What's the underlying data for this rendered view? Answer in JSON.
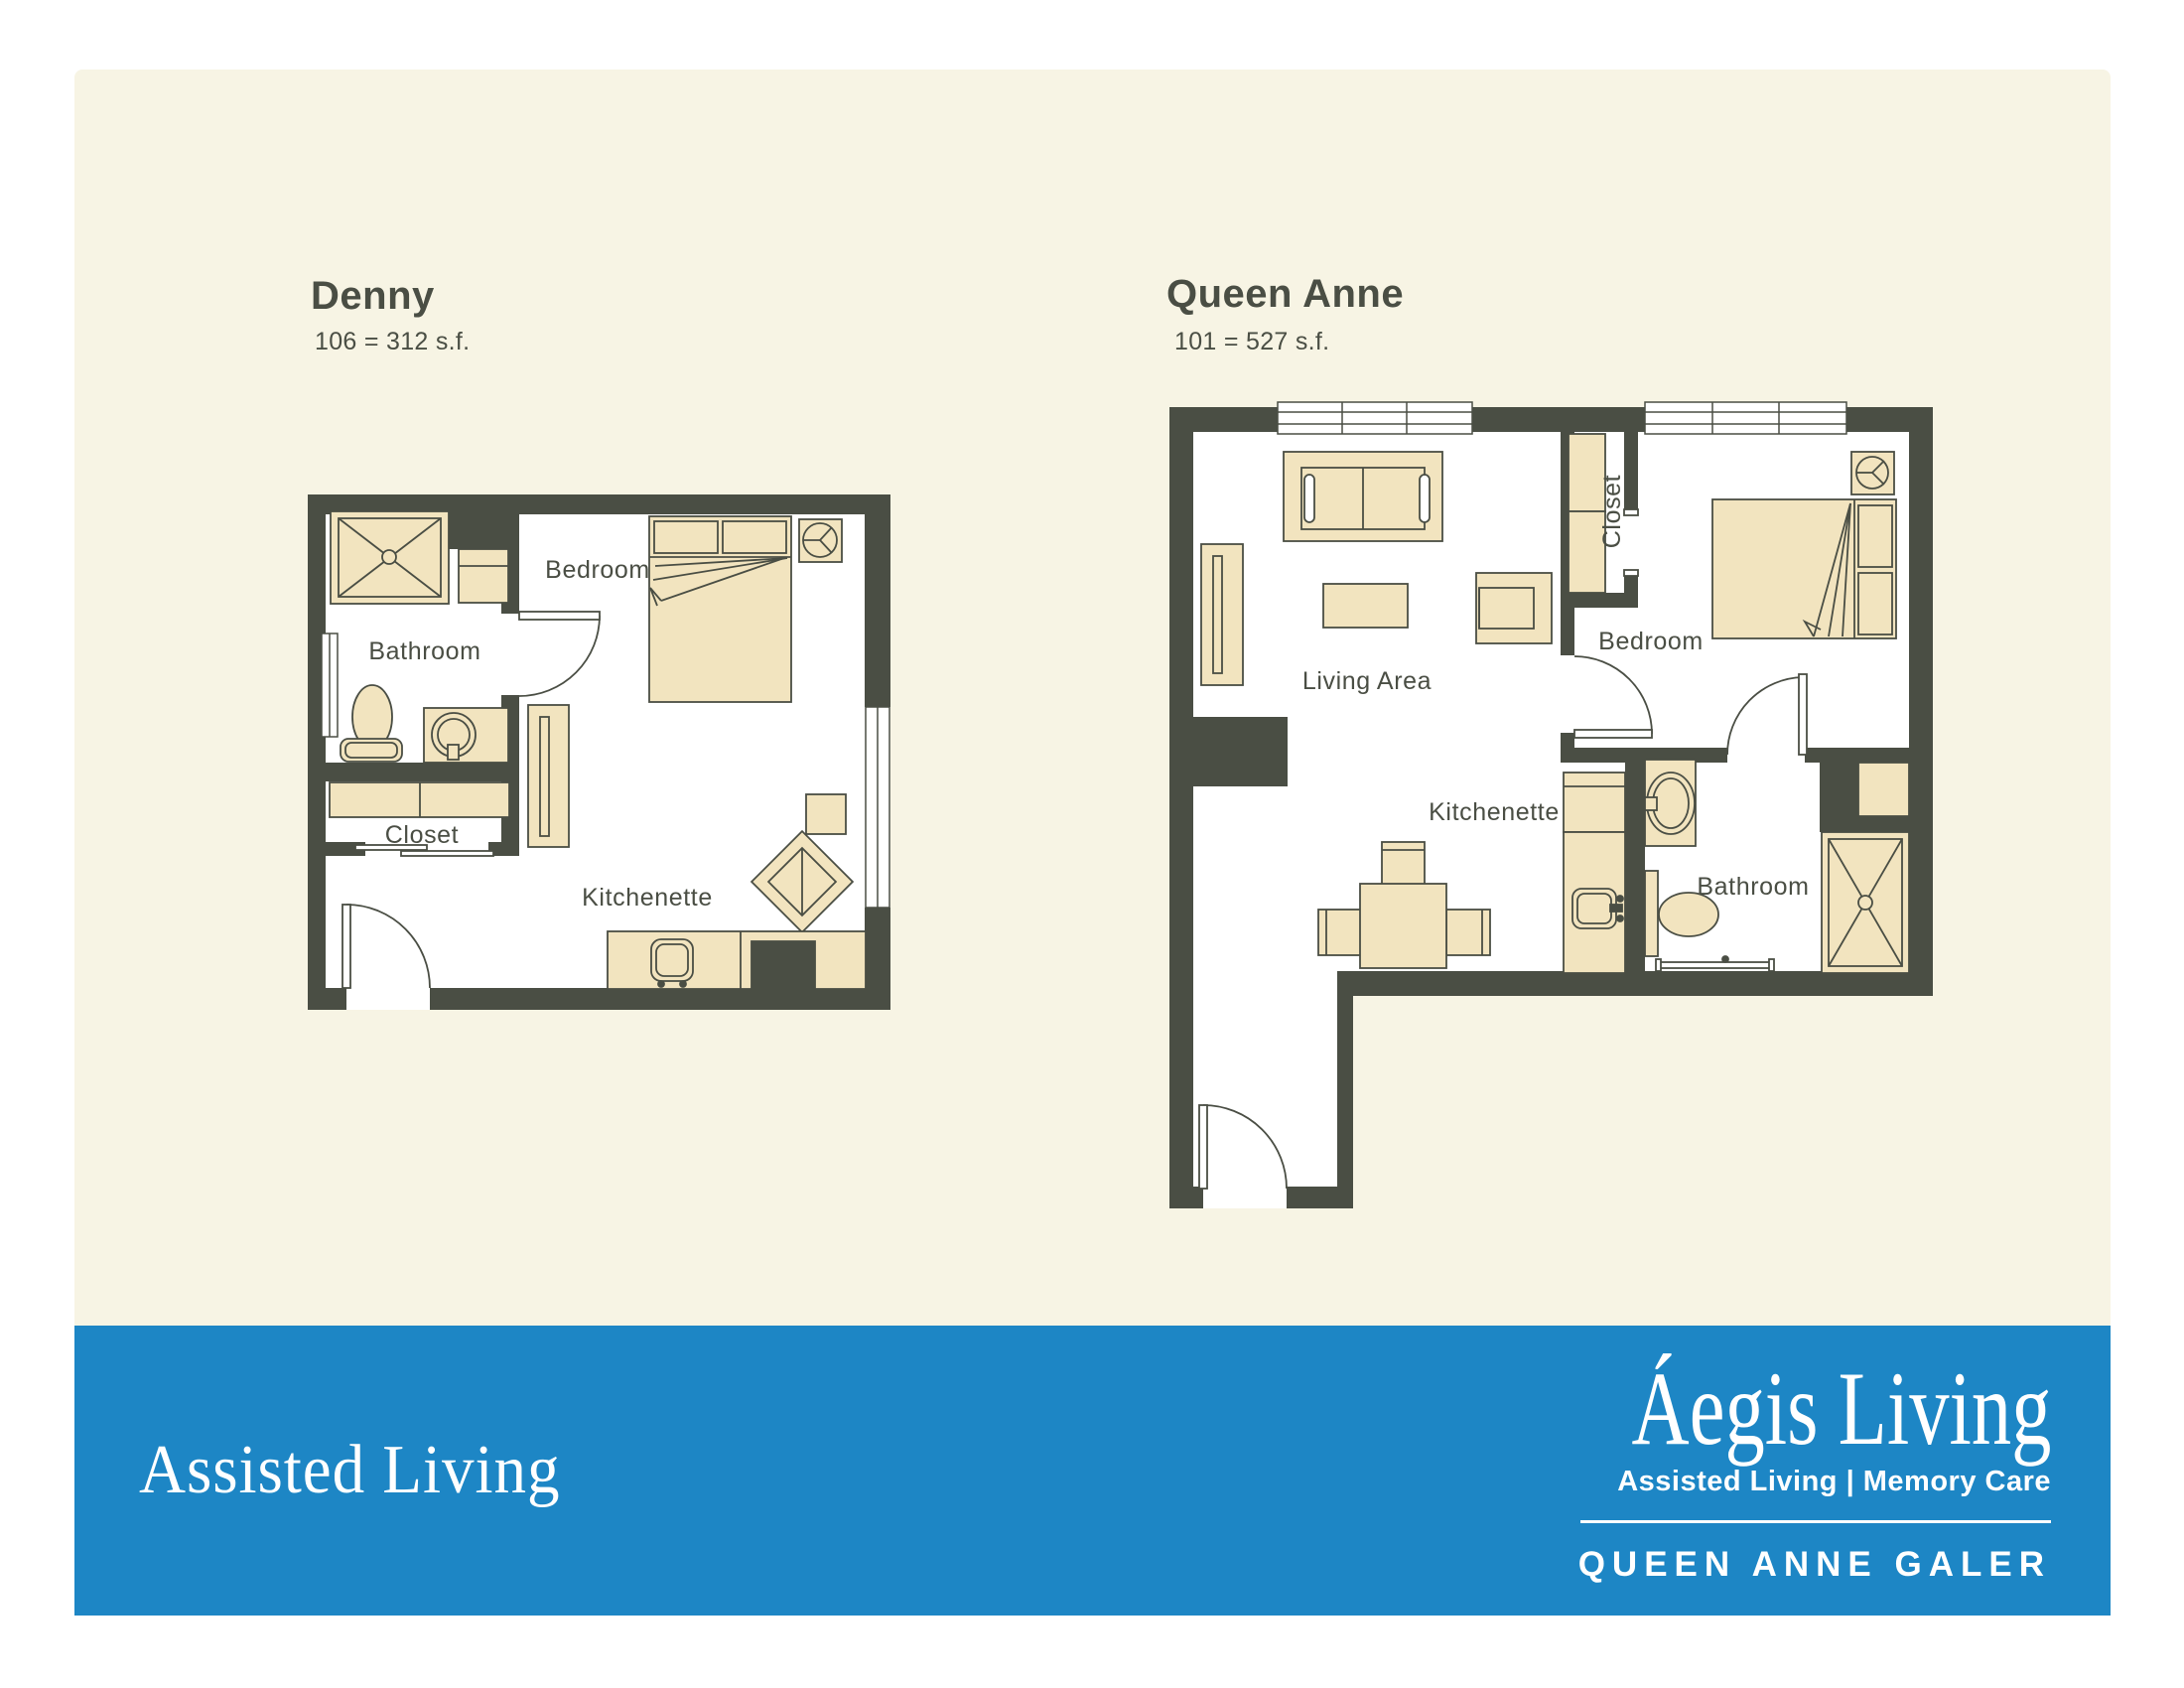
{
  "colors": {
    "background_white": "#ffffff",
    "canvas_cream": "#f7f4e4",
    "wall_dark": "#4a4e44",
    "furniture_tan": "#f2e4bf",
    "floor_white": "#ffffff",
    "banner_blue": "#1d86c5",
    "banner_text": "#ffffff",
    "label_text": "#4a4e44"
  },
  "plans": [
    {
      "id": "denny",
      "title": "Denny",
      "subtitle": "106 = 312 s.f.",
      "rooms": [
        {
          "label": "Bathroom"
        },
        {
          "label": "Bedroom"
        },
        {
          "label": "Closet"
        },
        {
          "label": "Kitchenette"
        }
      ]
    },
    {
      "id": "queen-anne",
      "title": "Queen Anne",
      "subtitle": "101 = 527 s.f.",
      "rooms": [
        {
          "label": "Living Area"
        },
        {
          "label": "Closet"
        },
        {
          "label": "Bedroom"
        },
        {
          "label": "Kitchenette"
        },
        {
          "label": "Bathroom"
        }
      ]
    }
  ],
  "banner": {
    "left_title": "Assisted Living",
    "logo": {
      "name": "Áegis Living",
      "tagline": "Assisted Living | Memory Care",
      "community": "QUEEN ANNE GALER"
    }
  }
}
